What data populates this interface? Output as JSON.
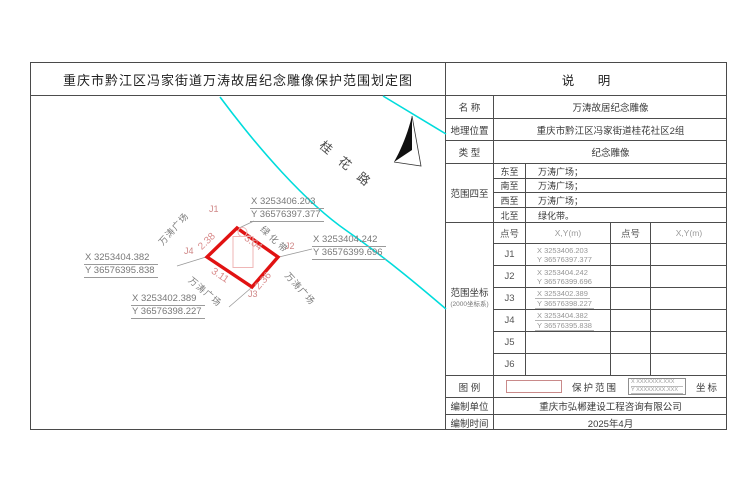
{
  "sheet_title": "重庆市黔江区冯家街道万涛故居纪念雕像保护范围划定图",
  "notes_header": "说 明",
  "info": {
    "name_label": "名 称",
    "name_value": "万涛故居纪念雕像",
    "location_label": "地理位置",
    "location_value": "重庆市黔江区冯家街道桂花社区2组",
    "type_label": "类 型",
    "type_value": "纪念雕像"
  },
  "bounds": {
    "label": "范围四至",
    "rows": [
      {
        "dir": "东至",
        "value": "万涛广场；"
      },
      {
        "dir": "南至",
        "value": "万涛广场；"
      },
      {
        "dir": "西至",
        "value": "万涛广场；"
      },
      {
        "dir": "北至",
        "value": "绿化带。"
      }
    ]
  },
  "coords": {
    "label": "范围坐标",
    "sublabel": "(2000坐标系)",
    "point_header": "点号",
    "xy_header": "X,Y(m)",
    "points": [
      {
        "id": "J1",
        "x": "X 3253406.203",
        "y": "Y 36576397.377"
      },
      {
        "id": "J2",
        "x": "X 3253404.242",
        "y": "Y 36576399.696"
      },
      {
        "id": "J3",
        "x": "X 3253402.389",
        "y": "Y 36576398.227"
      },
      {
        "id": "J4",
        "x": "X 3253404.382",
        "y": "Y 36576395.838"
      },
      {
        "id": "J5",
        "x": "",
        "y": ""
      },
      {
        "id": "J6",
        "x": "",
        "y": ""
      }
    ]
  },
  "legend": {
    "label": "图 例",
    "protection_label": "保护范围",
    "coord_label": "坐标",
    "coord_sample_x": "X XXXXXXX.XXX",
    "coord_sample_y": "Y XXXXXXXX.XXX"
  },
  "footer": {
    "unit_label": "编制单位",
    "unit_value": "重庆市弘郴建设工程咨询有限公司",
    "date_label": "编制时间",
    "date_value": "2025年4月"
  },
  "map": {
    "road_label": "桂花路",
    "green_belt_label": "绿化带",
    "plaza_label": "万涛广场",
    "dims": {
      "left_top": "2.38",
      "right_top": "3.04",
      "left_bottom": "3.11",
      "right_bottom": "2.36"
    },
    "points": {
      "j1": {
        "id": "J1",
        "x": "X 3253406.203",
        "y": "Y 36576397.377"
      },
      "j2": {
        "id": "J2",
        "x": "X 3253404.242",
        "y": "Y 36576399.696"
      },
      "j3": {
        "id": "J3",
        "x": "X 3253402.389",
        "y": "Y 36576398.227"
      },
      "j4": {
        "id": "J4",
        "x": "X 3253404.382",
        "y": "Y 36576395.838"
      }
    },
    "colors": {
      "road": "#00dcdc",
      "boundary": "#e11212",
      "dimension": "#d98c8c",
      "label_gray": "#7a7a7a"
    }
  }
}
